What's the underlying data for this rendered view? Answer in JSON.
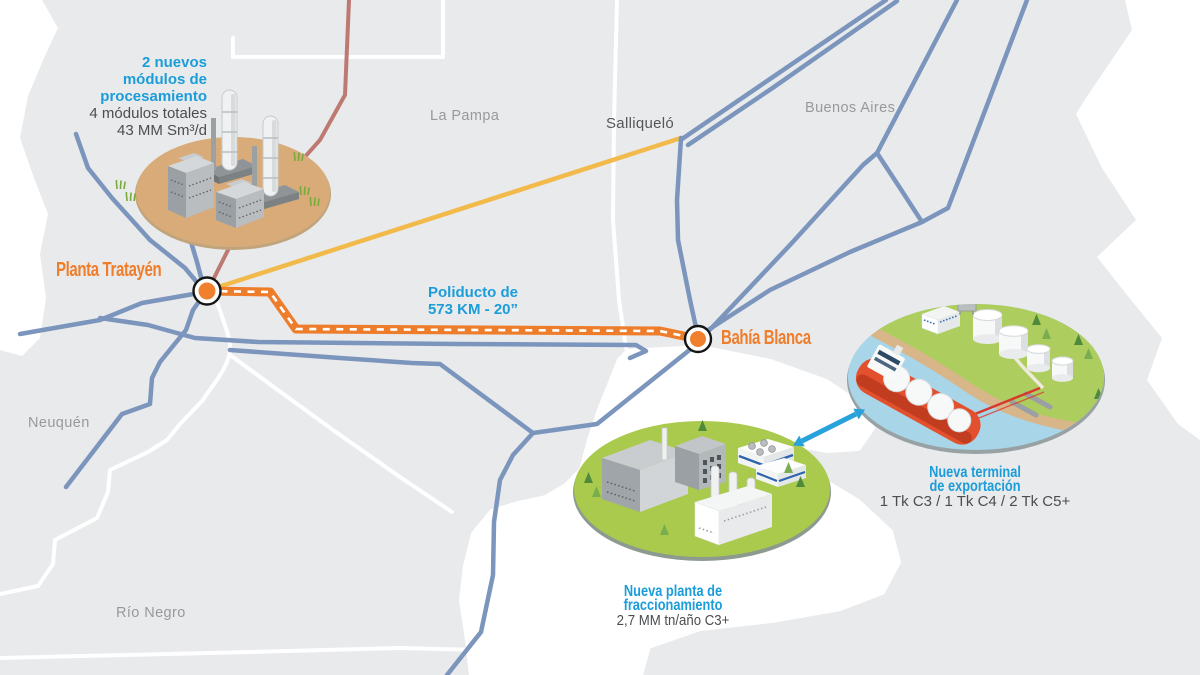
{
  "colors": {
    "accent_blue": "#1b9dd9",
    "accent_orange": "#f07d2a",
    "pipeline_orange": "#ee7d2b",
    "network_blue": "#7b95bd",
    "branch_brown": "#bd7a72",
    "salliquelo_yellow": "#f2ba4b",
    "land_gray": "#e9eaec"
  },
  "provinces": {
    "neuquen": "Neuquén",
    "rio_negro": "Río Negro",
    "la_pampa": "La Pampa",
    "buenos_aires": "Buenos Aires"
  },
  "places": {
    "planta_tratayen": "Planta Tratayén",
    "bahia_blanca": "Bahía Blanca",
    "salliquelo": "Salliqueló"
  },
  "pipeline_label": {
    "line1": "Poliducto de",
    "line2": "573 KM - 20”"
  },
  "processing_plant": {
    "headline_line1": "2 nuevos",
    "headline_line2": "módulos de",
    "headline_line3": "procesamiento",
    "spec_line1": "4 módulos totales",
    "spec_line2": "43 MM Sm³/d"
  },
  "fractionation_plant": {
    "headline_line1": "Nueva planta de",
    "headline_line2": "fraccionamiento",
    "spec": "2,7 MM tn/año C3+"
  },
  "export_terminal": {
    "headline_line1": "Nueva terminal",
    "headline_line2": "de exportación",
    "spec": "1 Tk C3 / 1 Tk C4 / 2 Tk C5+"
  }
}
